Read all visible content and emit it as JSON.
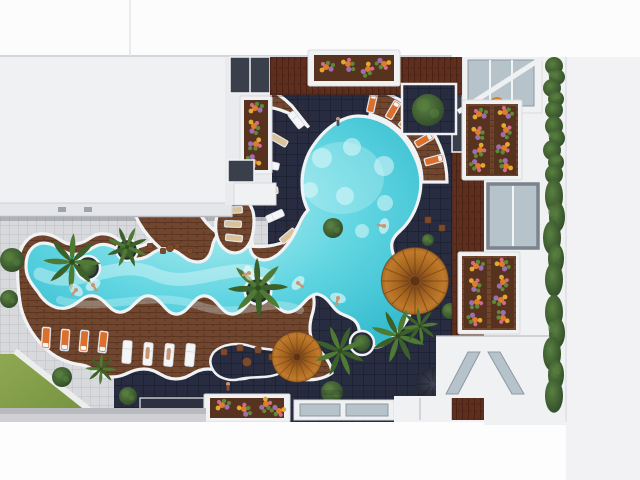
{
  "scene": {
    "title": "Aerial top-down 3D architectural render of a residential courtyard pool",
    "view": "top-down aerial",
    "style": "architectural visualization, no text on screen",
    "areas": {
      "pool": "freeform lazy-river pool joined to a circular lagoon with in-floor lights",
      "deck": "wavy-edged hardwood sun deck with lounger rows",
      "courtyard": "dark navy tiled courtyard",
      "plaza": "light grey checkered plaza with lawn wedge and round bushes",
      "left_building": "white flat-roof block with balconies and flower boxes",
      "right_building": "balconied facade with flower planters, hedge row and skylights"
    }
  },
  "objects": {
    "parasols": [
      {
        "id": "large-rattan-parasol",
        "color": "orange"
      },
      {
        "id": "medium-rattan-parasol",
        "color": "orange"
      },
      {
        "id": "small-dark-parasol",
        "color": "charcoal"
      }
    ],
    "sun_loungers": {
      "white": 7,
      "orange": 9,
      "tan": 6
    },
    "palm_trees": 7,
    "round_bushes": 9,
    "hedge_segments": 4,
    "flower_planters": 6,
    "ring_planters": 4,
    "skylights": 4,
    "people": {
      "swimmers": 6,
      "on_deck": 4
    }
  },
  "palette": {
    "bg": "#fdfdfe",
    "roof": "#f0f1f3",
    "roofTier": "#e4e6ea",
    "roofEdge": "#bcc0c7",
    "wallWhite": "#eaebef",
    "navy": "#272c40",
    "navyLine": "#1e2334",
    "plaza": "#d8d9dc",
    "plazaLine": "#c6c7cb",
    "wood": "#70462e",
    "woodLine": "#55301c",
    "woodRed": "#5e2f1f",
    "woodRedLine": "#452012",
    "water": "#62d6e2",
    "waterLight": "#b9eef1",
    "waterDeep": "#35bccf",
    "foam": "#e9fbfb",
    "rim": "#f0f2f4",
    "grassHi": "#8fa852",
    "grassLo": "#74913e",
    "bush": "#2f4a28",
    "bushLight": "#5a8040",
    "palmA": "#4e7a33",
    "palmB": "#3c6128",
    "palmC": "#2f4d1f",
    "parasolCore": "#6e3d1c",
    "parasolMid": "#a5651f",
    "parasol": "#c07a2b",
    "parasolRim": "#8d5a20",
    "parasolLine": "#5e3312",
    "parasolDarkA": "#3f4456",
    "parasolDarkB": "#232734",
    "lngFrame": "#edeff2",
    "lngStroke": "#c7cbd2",
    "lngPadW": "#f4f5f7",
    "lngPadO": "#dd6f2c",
    "lngPadT": "#d9c29a",
    "chair": "#7b4a2a",
    "chairLine": "#5c3118",
    "soil": "#57331f",
    "fO": "#e07b28",
    "fP": "#9b6fb0",
    "fY": "#e2a833",
    "fG": "#5d8a3a",
    "fPk": "#d66a8e",
    "glass": "#b7c3ca",
    "glassDark": "#8b99a3",
    "frameGray": "#7b838c",
    "skin": "#c89572",
    "shadow": "#1b1f2e"
  }
}
